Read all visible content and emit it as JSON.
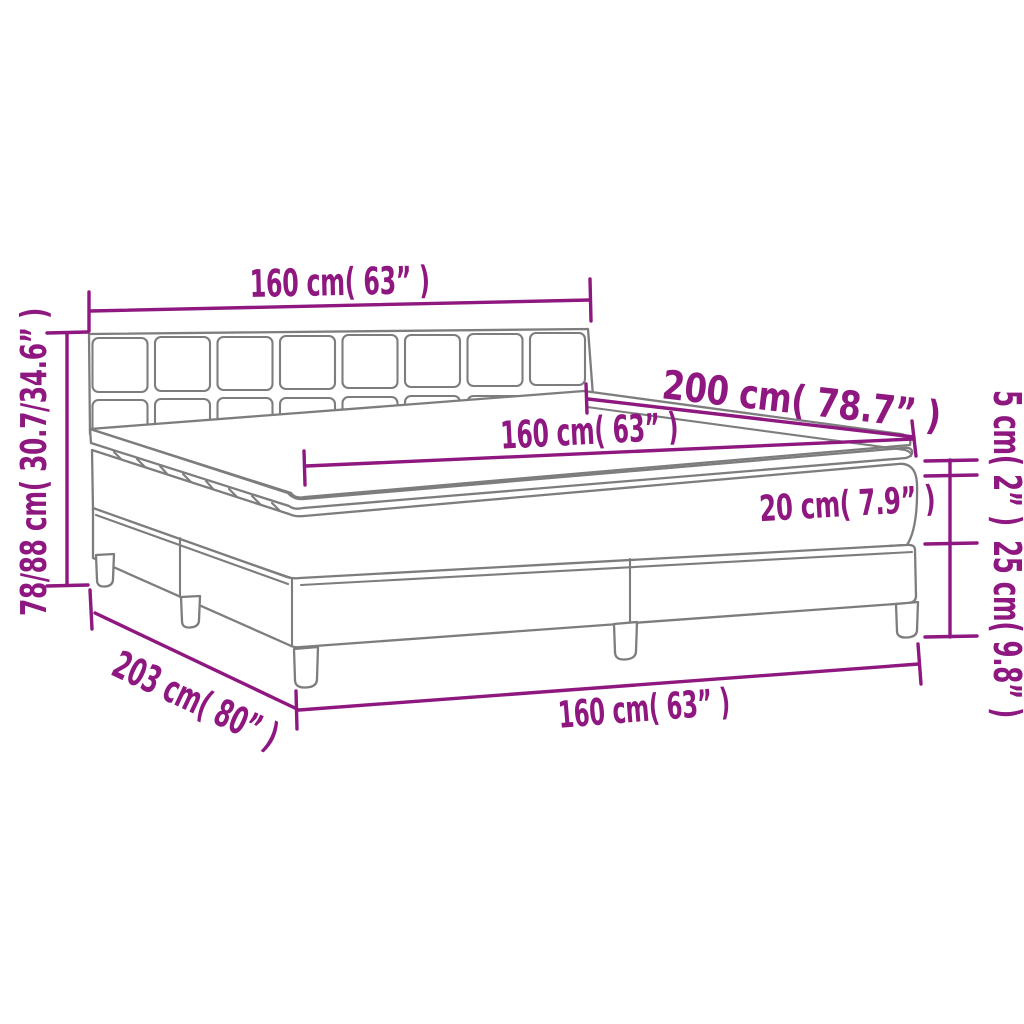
{
  "diagram": {
    "subject": "box-spring-bed-dimension-diagram",
    "colors": {
      "accent": "#8E1780",
      "outline": "#7D7D7D",
      "background": "#FFFFFF"
    },
    "dimensions": {
      "headboard_width": "160 cm( 63” )",
      "mattress_length": "200 cm( 78.7” )",
      "mattress_width": "160 cm( 63” )",
      "mattress_height": "20 cm( 7.9” )",
      "topper_height": "5 cm( 2” )",
      "base_height": "25 cm( 9.8” )",
      "total_height": "78/88 cm( 30.7/34.6” )",
      "total_length": "203 cm( 80” )",
      "base_width": "160 cm( 63” )"
    }
  }
}
